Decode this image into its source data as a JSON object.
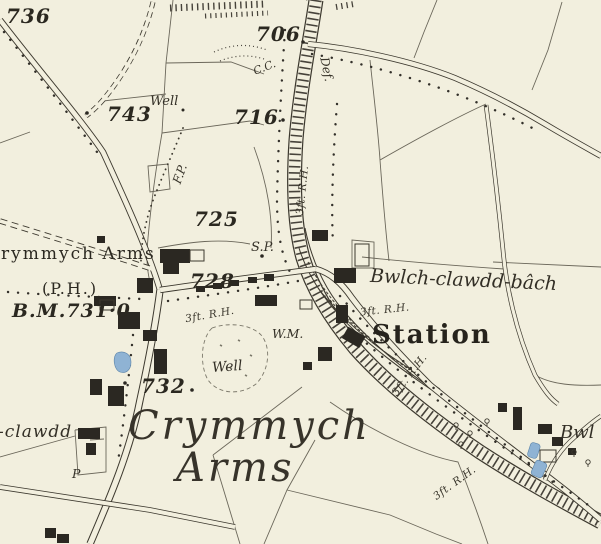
{
  "map": {
    "region_name_large_line1": "Crymmych",
    "region_name_large_line2": "Arms",
    "background_color": "#f2efde",
    "ink_color": "#3c382e",
    "building_color": "#2b2822",
    "water_color": "#8fb3d4"
  },
  "labels": {
    "spot_736": "736",
    "spot_706": "706",
    "spot_743": "743",
    "spot_716": "716",
    "spot_725": "725",
    "spot_728": "728",
    "spot_732": "732",
    "benchmark_731": "B.M.731·0",
    "benchmark_fragment": "703·1",
    "well_north": "Well",
    "well_south": "Well",
    "footpath_abbrev": "F.P.",
    "county_council_abbrev": "C.C.",
    "boundary_def_abbrev": "Def.",
    "signal_post_abbrev": "S.P.",
    "weighing_machine_abbrev": "W.M.",
    "pump_abbrev": "P",
    "rail_height_top": "3ft. R.H.",
    "rail_height_street": "3ft. R.H.",
    "rail_height_station": "3ft. R.H.",
    "rail_height_mid": "3ft. R.H.",
    "rail_height_bottom": "3ft. R.H.",
    "pub_name": "Crymmych Arms",
    "pub_abbrev": "(P.H.)",
    "farm_bwlch_clawdd_bach": "Bwlch-clawdd-bâch",
    "farm_clawdd_partial": "-clawdd",
    "farm_bwl_partial": "Bwl",
    "station_name": "Station",
    "big_name_line1": "Crymmych",
    "big_name_line2": "Arms"
  }
}
